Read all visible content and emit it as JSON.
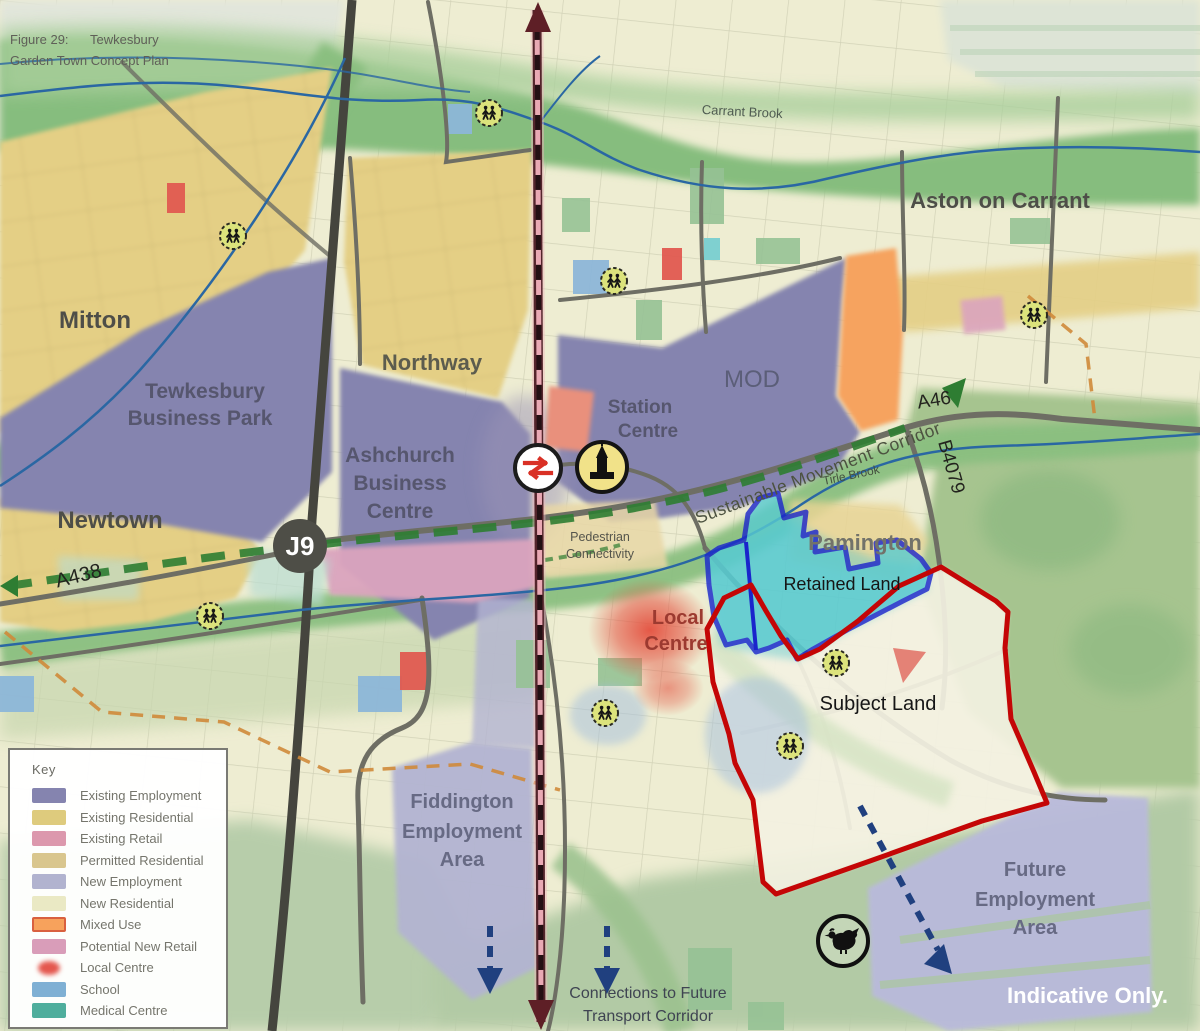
{
  "figure": {
    "line1": "Figure 29:      Tewkesbury",
    "line2": "Garden Town Concept Plan"
  },
  "map": {
    "places": {
      "mitton": "Mitton",
      "tewkesbury_business_park": [
        "Tewkesbury",
        "Business Park"
      ],
      "northway": "Northway",
      "ashchurch_business_centre": [
        "Ashchurch",
        "Business",
        "Centre"
      ],
      "newtown": "Newtown",
      "station_centre": [
        "Station",
        "Centre"
      ],
      "mod": "MOD",
      "aston_on_carrant": "Aston on Carrant",
      "pamington": "Pamington",
      "local_centre": [
        "Local",
        "Centre"
      ],
      "fiddington_employment_area": [
        "Fiddington",
        "Employment",
        "Area"
      ],
      "future_employment_area": [
        "Future",
        "Employment",
        "Area"
      ]
    },
    "roads": {
      "j9": "J9",
      "a438": "A438",
      "a46": "A46",
      "b4079": "B4079"
    },
    "water": {
      "carrant_brook": "Carrant Brook",
      "tirle_brook": "Tirle Brook"
    },
    "annotations": {
      "sustainable_movement_corridor": "Sustainable Movement Corridor",
      "pedestrian_connectivity": [
        "Pedestrian",
        "Connectivity"
      ],
      "retained_land": "Retained Land",
      "subject_land": "Subject Land",
      "connections": [
        "Connections to Future",
        "Transport Corridor"
      ],
      "indicative_only": "Indicative Only."
    },
    "icons": [
      "rail-station-icon",
      "church-icon",
      "school-crossing-icon",
      "hen-icon"
    ]
  },
  "legend": {
    "title": "Key",
    "items": [
      {
        "label": "Existing Employment",
        "color": "#8584af"
      },
      {
        "label": "Existing Residential",
        "color": "#decb7d"
      },
      {
        "label": "Existing Retail",
        "color": "#dc98ad"
      },
      {
        "label": "Permitted Residential",
        "color": "#d9c68e"
      },
      {
        "label": "New Employment",
        "color": "#b1b3cf"
      },
      {
        "label": "New Residential",
        "color": "#eae9c4"
      },
      {
        "label": "Mixed Use",
        "color": "#f7a25c"
      },
      {
        "label": "Potential New Retail",
        "color": "#d99db9"
      },
      {
        "label": "Local Centre",
        "color": "#e4574e"
      },
      {
        "label": "School",
        "color": "#7fb0d4"
      },
      {
        "label": "Medical Centre",
        "color": "#4fae9d"
      }
    ]
  },
  "colors": {
    "subject_boundary": "#c40606",
    "retained_boundary": "#1a24cc",
    "retained_fill": "#58cbd1",
    "corridor_green": "#2e7d32",
    "transport_arrow_blue": "#20407f",
    "boundary_orange_dash": "#cf8a3a",
    "railway_dark": "#54252c",
    "railway_pink": "#e9a9b4",
    "water_blue": "#2a67a3"
  }
}
